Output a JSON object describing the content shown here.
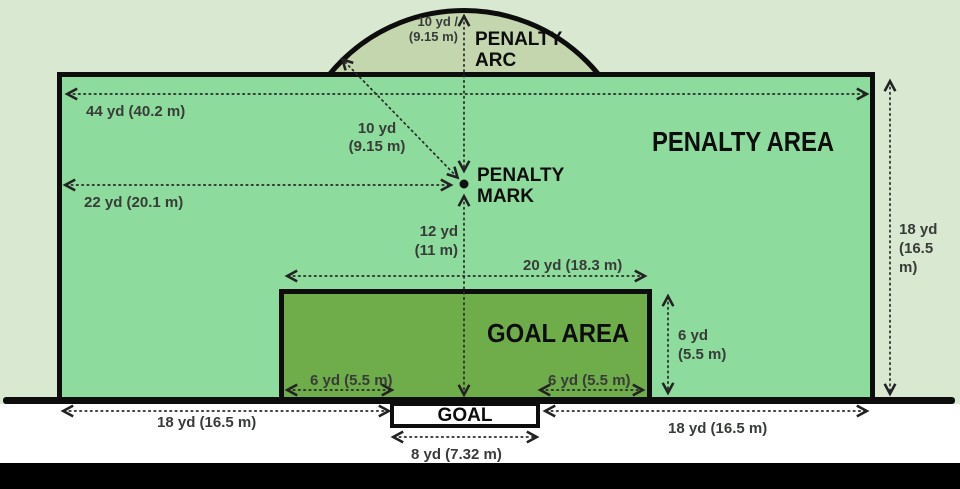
{
  "areas": {
    "penalty_area": "PENALTY AREA",
    "goal_area": "GOAL AREA",
    "penalty_arc_l1": "PENALTY",
    "penalty_arc_l2": "ARC",
    "penalty_mark_l1": "PENALTY",
    "penalty_mark_l2": "MARK",
    "goal": "GOAL"
  },
  "measurements": {
    "penalty_area_width": "44 yd (40.2 m)",
    "mark_from_side": "22 yd (20.1 m)",
    "arc_radius_l1": "10 yd /",
    "arc_radius_l2": "(9.15 m)",
    "diag_radius_l1": "10 yd",
    "diag_radius_l2": "(9.15 m)",
    "mark_from_goal_l1": "12 yd",
    "mark_from_goal_l2": "(11 m)",
    "goal_area_width": "20 yd (18.3 m)",
    "six_left": "6 yd (5.5 m)",
    "six_right": "6 yd (5.5 m)",
    "six_vert_l1": "6 yd",
    "six_vert_l2": "(5.5 m)",
    "penalty_depth_l1": "18 yd",
    "penalty_depth_l2": "(16.5",
    "penalty_depth_l3": "m)",
    "bottom_left_18": "18 yd (16.5 m)",
    "bottom_right_18": "18 yd (16.5 m)",
    "goal_width": "8 yd (7.32 m)"
  },
  "colors": {
    "bg-light": "#d9e8d1",
    "penalty-green": "#8edc9d",
    "goal-green": "#6fad4a",
    "arc-green": "#c4d6ae",
    "line-black": "#0d0d0d",
    "measure-text": "#383c38",
    "dotted": "#2a2a2a",
    "strip-white": "#ffffff",
    "bar-black": "#000000"
  }
}
